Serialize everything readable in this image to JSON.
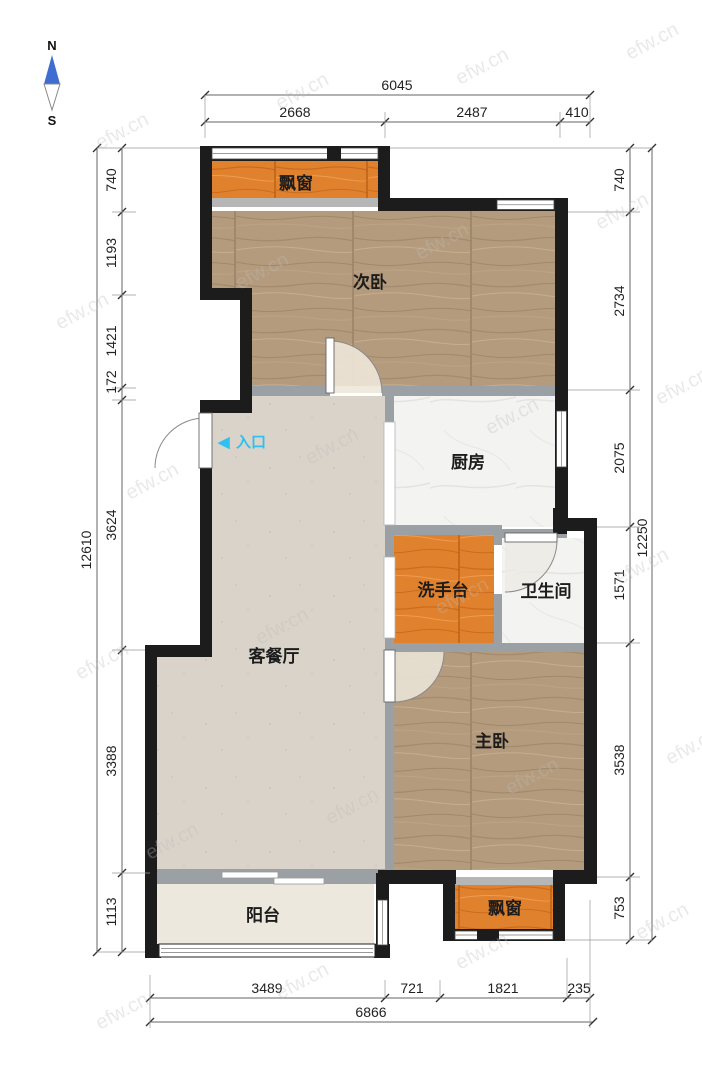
{
  "compass": {
    "north": "N",
    "south": "S"
  },
  "entrance": {
    "arrow": "◀",
    "label": "入口"
  },
  "rooms": {
    "bay_window_top": "飘窗",
    "second_bedroom": "次卧",
    "kitchen": "厨房",
    "wash_basin": "洗手台",
    "bathroom": "卫生间",
    "living_dining": "客餐厅",
    "master_bedroom": "主卧",
    "balcony": "阳台",
    "bay_window_bottom": "飘窗"
  },
  "dimensions": {
    "top": {
      "overall": "6045",
      "segments": [
        "2668",
        "2487",
        "410"
      ]
    },
    "bottom": {
      "overall": "6866",
      "segments": [
        "3489",
        "721",
        "1821",
        "235"
      ]
    },
    "left": {
      "overall": "12610",
      "segments": [
        "740",
        "1193",
        "1421",
        "172",
        "3624",
        "3388",
        "1113"
      ]
    },
    "right": {
      "overall": "12250",
      "segments": [
        "740",
        "2734",
        "2075",
        "1571",
        "3538",
        "753"
      ]
    }
  },
  "watermark": {
    "text": "efw.cn"
  },
  "colors": {
    "wall_black": "#1c1c1c",
    "wall_gray": "#9aa0a4",
    "wood_floor": "#b49b7d",
    "bay_orange": "#e0812e",
    "living_floor": "#d9d3ca",
    "balcony_floor": "#ece8de",
    "tile_white": "#f3f3f1",
    "entrance_cyan": "#2fc0f2",
    "compass_blue": "#3f6ed0"
  }
}
